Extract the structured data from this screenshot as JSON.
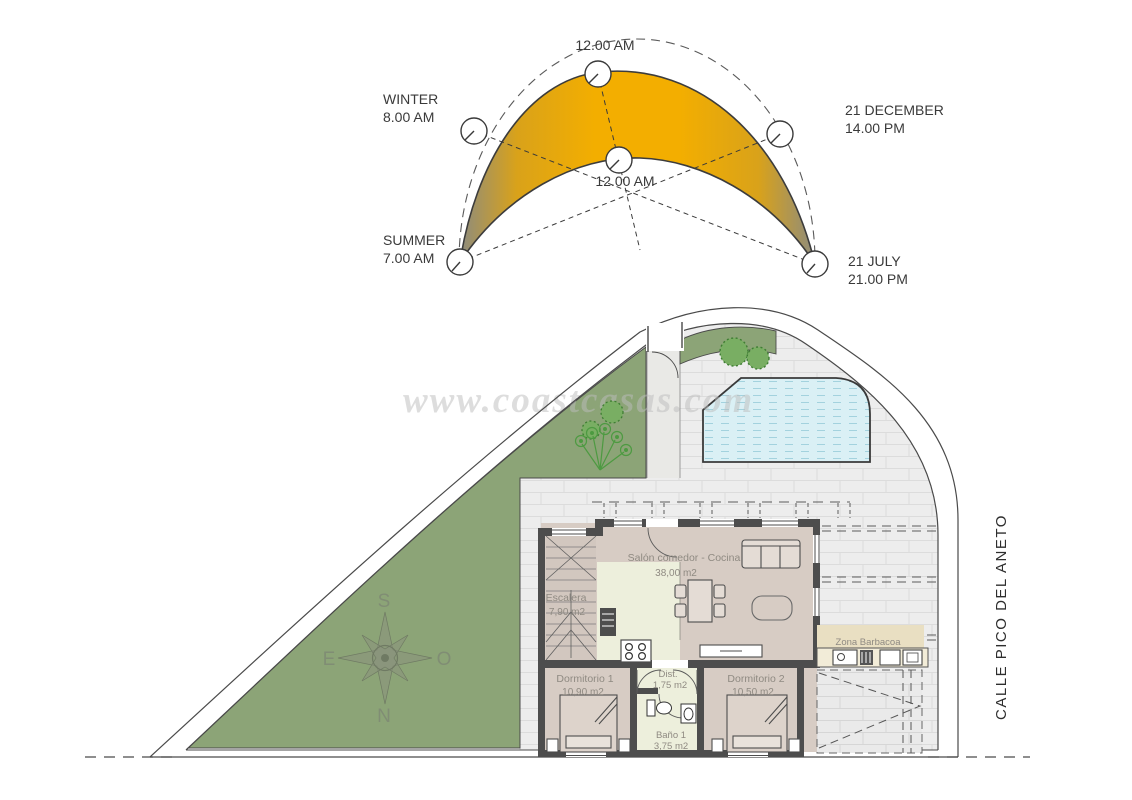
{
  "palette": {
    "sun_orange": "#f3ae00",
    "sun_tip_gray": "#8e8c7d",
    "garden_green": "#8ca477",
    "pool_blue": "#daf0f5",
    "terrace_gray": "#ededed",
    "house_floor": "#d7ccc4",
    "kitchen_cream": "#edefdc",
    "barbecue_beige": "#e9dfc2",
    "wall_dark": "#4d4d4d"
  },
  "sun_diagram": {
    "labels": {
      "top_time": "12.00 AM",
      "winter_season": "WINTER",
      "winter_time": "8.00 AM",
      "december_date": "21 DECEMBER",
      "december_time": "14.00 PM",
      "center_time": "12.00 AM",
      "summer_season": "SUMMER",
      "summer_time": "7.00 AM",
      "july_date": "21 JULY",
      "july_time": "21.00 PM"
    }
  },
  "floor_plan": {
    "watermark": "www.coastcasas.com",
    "street_name": "CALLE PICO DEL ANETO",
    "compass": {
      "south": "S",
      "east": "E",
      "west": "O",
      "north": "N"
    },
    "rooms": {
      "salon": {
        "name": "Salón comedor - Cocina",
        "area": "38,00 m2"
      },
      "escalera": {
        "name": "Escalera",
        "area": "7,90 m2"
      },
      "dormitorio1": {
        "name": "Dormitorio 1",
        "area": "10,90 m2"
      },
      "dist": {
        "name": "Dist.",
        "area": "1,75 m2"
      },
      "bano": {
        "name": "Baño 1",
        "area": "3,75 m2"
      },
      "dormitorio2": {
        "name": "Dormitorio 2",
        "area": "10,50 m2"
      },
      "barbacoa": {
        "name": "Zona Barbacoa"
      }
    }
  }
}
